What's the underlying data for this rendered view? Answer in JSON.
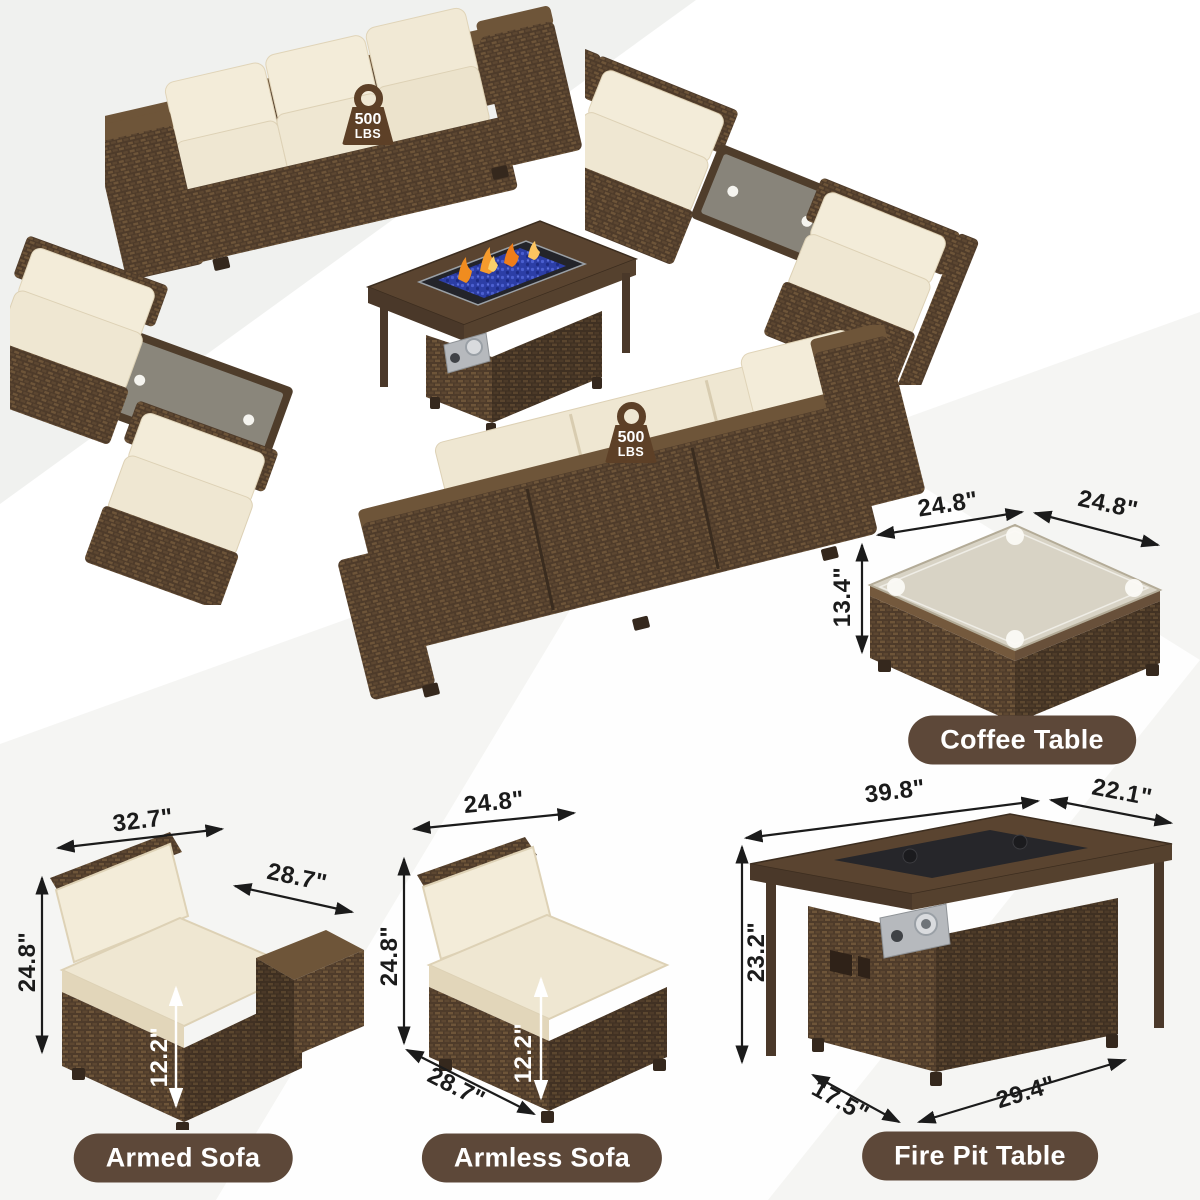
{
  "product_scene": {
    "description_note": "outdoor wicker patio furniture set product image",
    "weight_badges": [
      {
        "value": "500",
        "unit": "LBS"
      },
      {
        "value": "500",
        "unit": "LBS"
      }
    ]
  },
  "items": {
    "coffee_table": {
      "label": "Coffee Table",
      "top_width": "24.8\"",
      "top_depth": "24.8\"",
      "height": "13.4\""
    },
    "armed_sofa": {
      "label": "Armed Sofa",
      "width": "32.7\"",
      "depth": "28.7\"",
      "height": "24.8\"",
      "seat_height": "12.2\""
    },
    "armless_sofa": {
      "label": "Armless Sofa",
      "width": "24.8\"",
      "height": "24.8\"",
      "seat_height": "12.2\"",
      "depth": "28.7\""
    },
    "fire_pit_table": {
      "label": "Fire Pit Table",
      "top_width": "39.8\"",
      "top_depth": "22.1\"",
      "height": "23.2\"",
      "base_depth": "17.5\"",
      "base_width": "29.4\""
    }
  },
  "colors": {
    "wicker_brown": "#4e3b2a",
    "wicker_light": "#6e5539",
    "cushion_beige": "#efe7d2",
    "cushion_back": "#f3ecd9",
    "label_pill": "#5d4839",
    "label_text": "#ffffff",
    "dim_text": "#1b1b1b",
    "badge_brown": "#5d4027",
    "fire_glass_blue": "#2c3ea6",
    "flame_orange": "#f59b2d",
    "glass_gray": "#d8d3c5"
  }
}
